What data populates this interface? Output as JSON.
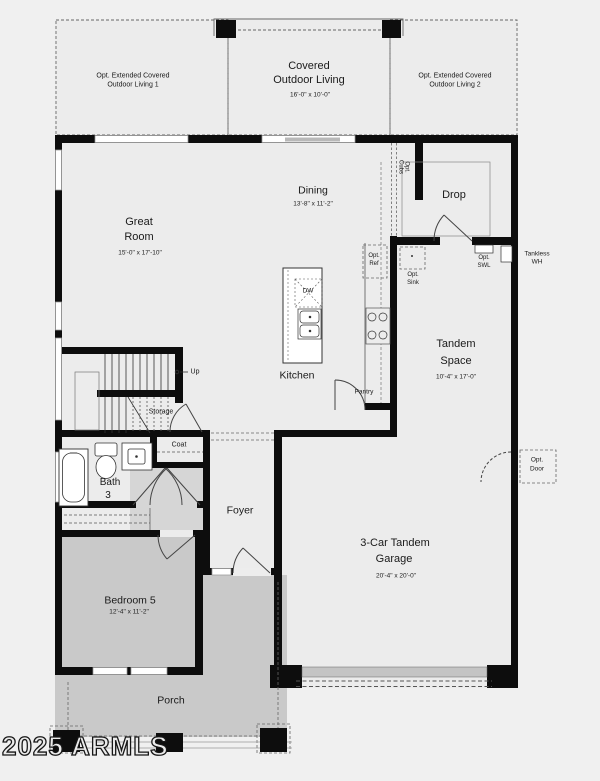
{
  "watermark": "2025 ARMLS",
  "colors": {
    "background": "#f0f0f0",
    "interior_fill": "#ececec",
    "porch_fill": "#c9c9c9",
    "wall": "#0d0d0d",
    "thin_line": "#555555",
    "garage_door_fill": "#c4c4c4"
  },
  "rooms": {
    "opt_outdoor_living_1": {
      "line1": "Opt. Extended Covered",
      "line2": "Outdoor Living 1"
    },
    "covered_outdoor_living": {
      "line1": "Covered",
      "line2": "Outdoor Living",
      "dim": "16'-0\" x 10'-0\""
    },
    "opt_outdoor_living_2": {
      "line1": "Opt. Extended Covered",
      "line2": "Outdoor Living 2"
    },
    "great_room": {
      "line1": "Great",
      "line2": "Room",
      "dim": "15'-0\" x 17'-10\""
    },
    "dining": {
      "name": "Dining",
      "dim": "13'-8\" x 11'-2\""
    },
    "drop": {
      "name": "Drop"
    },
    "kitchen": {
      "name": "Kitchen"
    },
    "tandem_space": {
      "line1": "Tandem",
      "line2": "Space",
      "dim": "10'-4\" x 17'-0\""
    },
    "bath_3": {
      "line1": "Bath",
      "line2": "3"
    },
    "foyer": {
      "name": "Foyer"
    },
    "bedroom_5": {
      "name": "Bedroom 5",
      "dim": "12'-4\" x 11'-2\""
    },
    "garage": {
      "line1": "3-Car Tandem",
      "line2": "Garage",
      "dim": "20'-4\" x 20'-0\""
    },
    "porch": {
      "name": "Porch"
    }
  },
  "annotations": {
    "up": "Up",
    "storage": "Storage",
    "coat": "Coat",
    "pantry": "Pantry",
    "dw": "DW",
    "opt_cubs": {
      "line1": "Opt.",
      "line2": "Cubs"
    },
    "opt_ref": {
      "line1": "Opt.",
      "line2": "Ref"
    },
    "opt_sink": {
      "line1": "Opt.",
      "line2": "Sink"
    },
    "opt_swl": {
      "line1": "Opt.",
      "line2": "SWL"
    },
    "tankless_wh": {
      "line1": "Tankless",
      "line2": "WH"
    },
    "opt_door": {
      "line1": "Opt.",
      "line2": "Door"
    }
  }
}
